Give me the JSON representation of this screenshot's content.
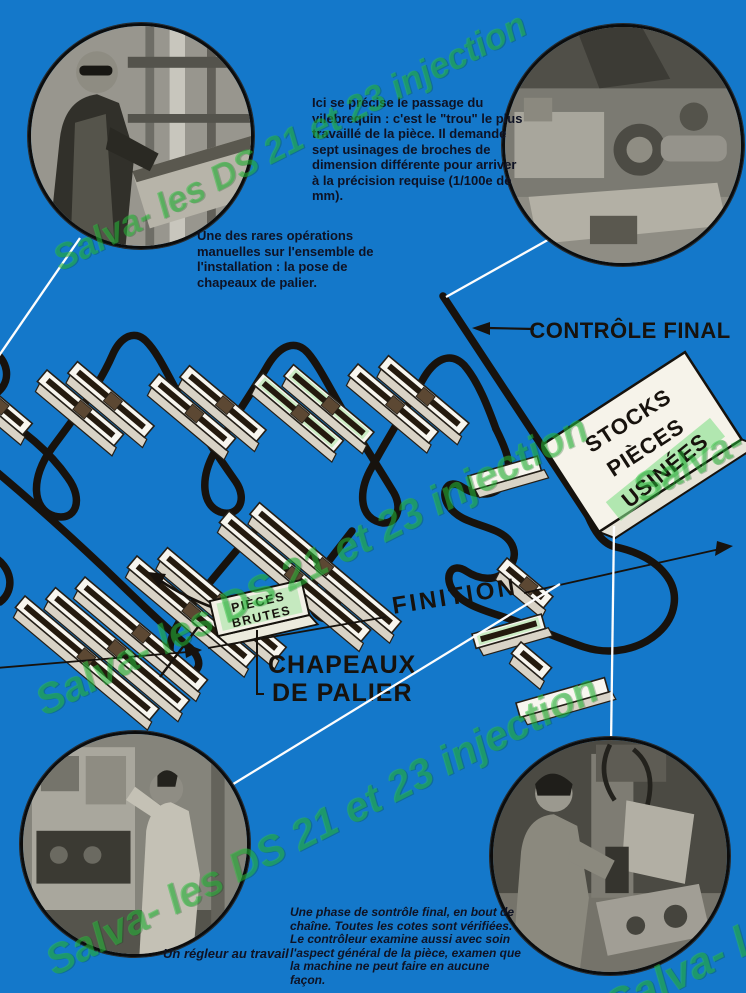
{
  "page": {
    "background": "#1478ca"
  },
  "captions": {
    "drilling": "Ici se précise le passage du vilebrequin : c'est le \"trou\" le plus travaillé de la pièce. Il demande sept usinages de broches de dimension différente pour arriver à la précision requise (1/100e de mm).",
    "manual": "Une des rares opérations manuelles sur l'ensemble de l'installation : la pose de chapeaux de palier.",
    "final_control": "Une phase de sontrôle final, en bout de chaîne. Toutes les cotes sont vérifiées. Le contrôleur examine aussi avec soin l'aspect général de la pièce, examen que la machine ne peut faire en aucune façon.",
    "regleur": "Un régleur au travail"
  },
  "diagram": {
    "controle_final": "CONTRÔLE FINAL",
    "finition": "FINITION",
    "chapeaux_line1": "CHAPEAUX",
    "chapeaux_line2": "DE PALIER",
    "stocks": [
      "STOCKS",
      "PIÈCES",
      "USINÉES"
    ],
    "pieces_brutes": [
      "PIÈCES",
      "BRUTES"
    ]
  },
  "watermark": {
    "text": "Salva- les DS 21 et 23 injection"
  },
  "colors": {
    "background": "#1478ca",
    "conveyor_line": "#17120d",
    "watermark_green": "#2cc33e",
    "slab_white": "#f6f3ea"
  }
}
